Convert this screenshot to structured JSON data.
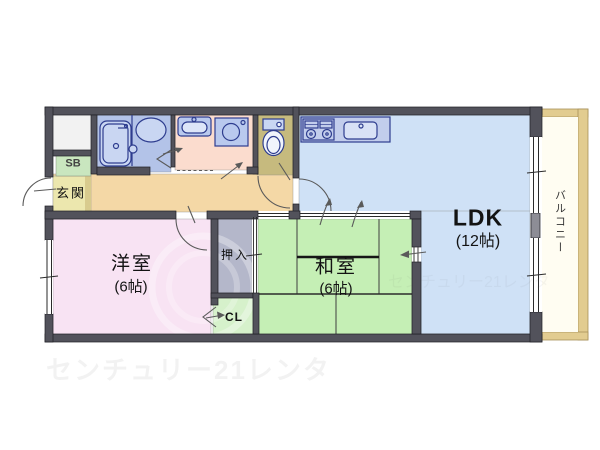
{
  "floorplan": {
    "rooms": {
      "ldk": {
        "label": "LDK",
        "size": "(12帖)",
        "color": "#cfe1f6"
      },
      "western_room": {
        "label": "洋室",
        "size": "(6帖)",
        "color": "#f8e3f3"
      },
      "japanese_room": {
        "label": "和室",
        "size": "(6帖)",
        "color": "#c5efb5"
      },
      "entrance": {
        "label": "玄関",
        "color": "#ece7ae"
      },
      "shoe_box": {
        "label": "SB",
        "color": "#c9e6bf"
      },
      "closet_oshiire": {
        "label": "押入",
        "color": "#b4b7ca"
      },
      "closet_cl": {
        "label": "CL",
        "color": "#d6f1cb"
      },
      "balcony": {
        "label": "バルコニー",
        "color": "#fffdf2"
      },
      "hallway": {
        "color": "#f4d8a6"
      },
      "hallway_step": {
        "color": "#d8cb8e"
      },
      "bathroom": {
        "color": "#b3c3e8"
      },
      "washroom": {
        "color": "#fbdcce"
      },
      "toilet": {
        "color": "#c6ba7e"
      },
      "kitchen_counter": {
        "color": "#c2cdec"
      },
      "meter_box": {
        "color": "#f2f2f2"
      }
    },
    "watermark": {
      "text": "センチュリー21レンタ"
    },
    "colors": {
      "wall": "#52525b",
      "wall_light": "#8d8d96",
      "fixture_line": "#2e3d8f",
      "fixture_fill": "#c9d6f2",
      "balcony_border": "#e2cc90",
      "door_arc": "#5a5a5a"
    }
  }
}
